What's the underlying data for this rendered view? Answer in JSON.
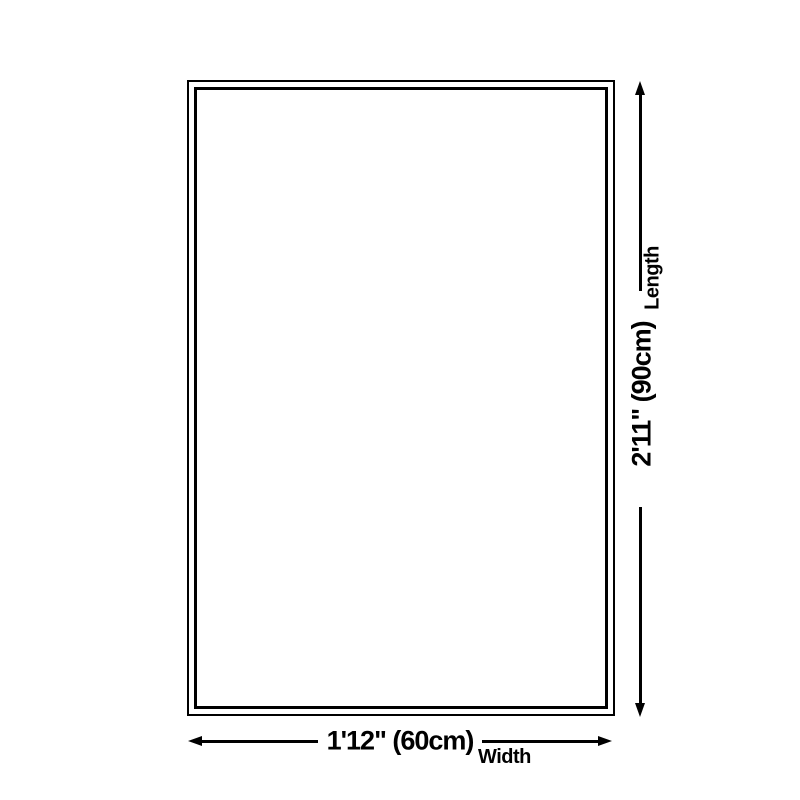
{
  "diagram": {
    "type": "product-dimension-diagram",
    "colors": {
      "background": "#ffffff",
      "line": "#000000",
      "text": "#000000"
    },
    "length": {
      "value": "2'11\" (90cm)",
      "label": "Length"
    },
    "width": {
      "value": "1'12\" (60cm)",
      "label": "Width"
    },
    "icons": {
      "up": "arrow-up-icon",
      "down": "arrow-down-icon",
      "left": "arrow-left-icon",
      "right": "arrow-right-icon"
    }
  }
}
